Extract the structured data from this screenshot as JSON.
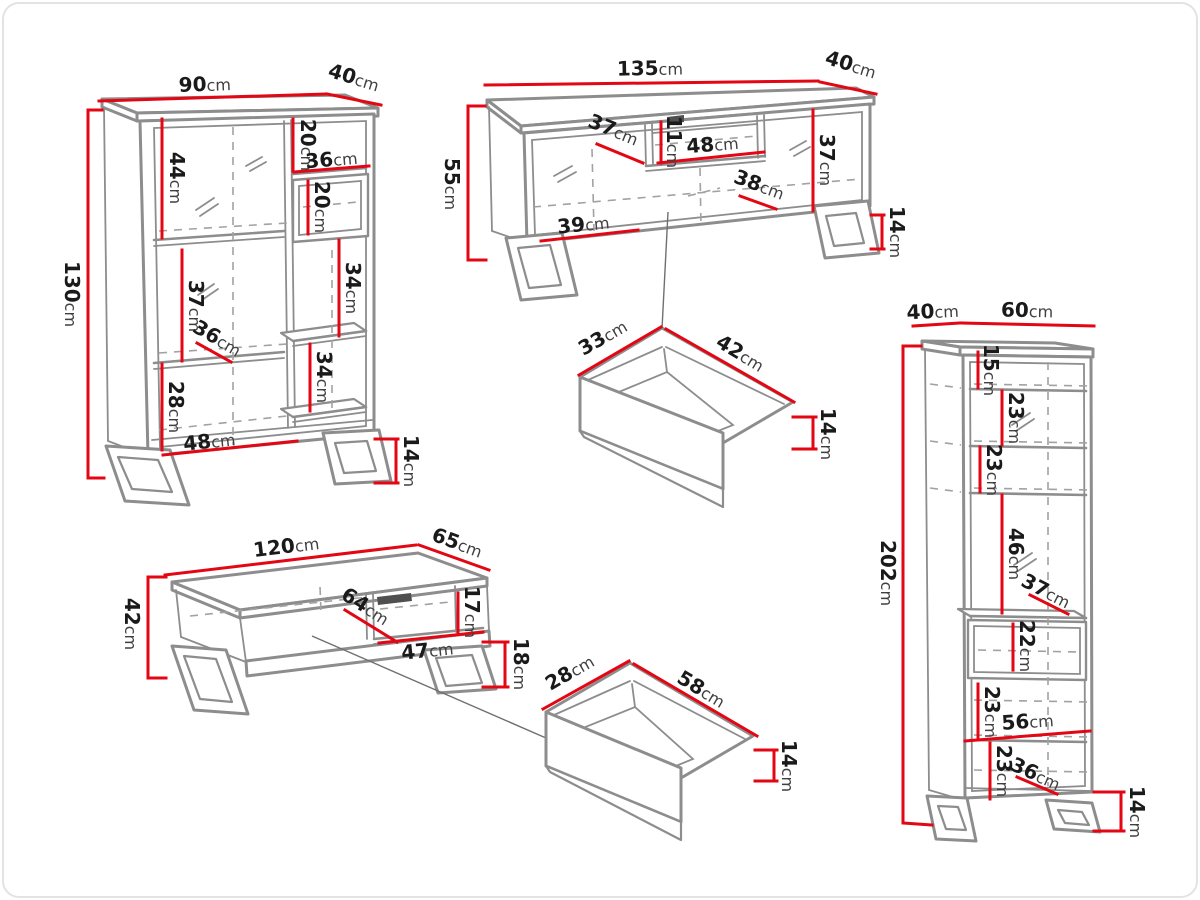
{
  "unit": "cm",
  "colors": {
    "red": "#e30613",
    "gray": "#8d8d8d",
    "dash": "#a2a2a2",
    "ink": "#1a1a1a",
    "ink2": "#3f3f3f",
    "slot": "#4f4f4f",
    "conn": "#6f6f6f",
    "border": "#e3e3e3",
    "bg": "#ffffff"
  },
  "pieces": {
    "cabinet": {
      "width": "90",
      "depth": "40",
      "height": "130",
      "leg_height": "14",
      "sections": {
        "upper_left": "44",
        "upper_right": "20",
        "niche_width": "36",
        "niche_height": "20",
        "middle_left": "37",
        "shelf_depth": "36",
        "lower_left": "28",
        "right_upper": "34",
        "right_lower": "34",
        "bottom_width": "48"
      }
    },
    "tv_stand": {
      "width": "135",
      "depth": "40",
      "height": "55",
      "leg_height": "14",
      "sections": {
        "left_width": "37",
        "niche_height": "11",
        "niche_width": "48",
        "right_height": "37",
        "right_width": "38",
        "bottom_width": "39"
      }
    },
    "tv_drawer": {
      "depth": "33",
      "width": "42",
      "height": "14"
    },
    "coffee_table": {
      "width": "120",
      "depth": "65",
      "height": "42",
      "leg_height": "18",
      "sections": {
        "niche_depth": "64",
        "niche_height": "17",
        "niche_width": "47"
      }
    },
    "table_drawer": {
      "width": "28",
      "depth": "58",
      "height": "14"
    },
    "column": {
      "depth": "40",
      "width": "60",
      "height": "202",
      "leg_height": "14",
      "sections": {
        "top_gap": "15",
        "shelf_1": "23",
        "shelf_2": "23",
        "glass_door": "46",
        "shelf_depth": "37",
        "niche_height": "22",
        "below_niche": "23",
        "inner_width": "56",
        "bottom_gap": "23",
        "base_depth": "36"
      }
    }
  }
}
